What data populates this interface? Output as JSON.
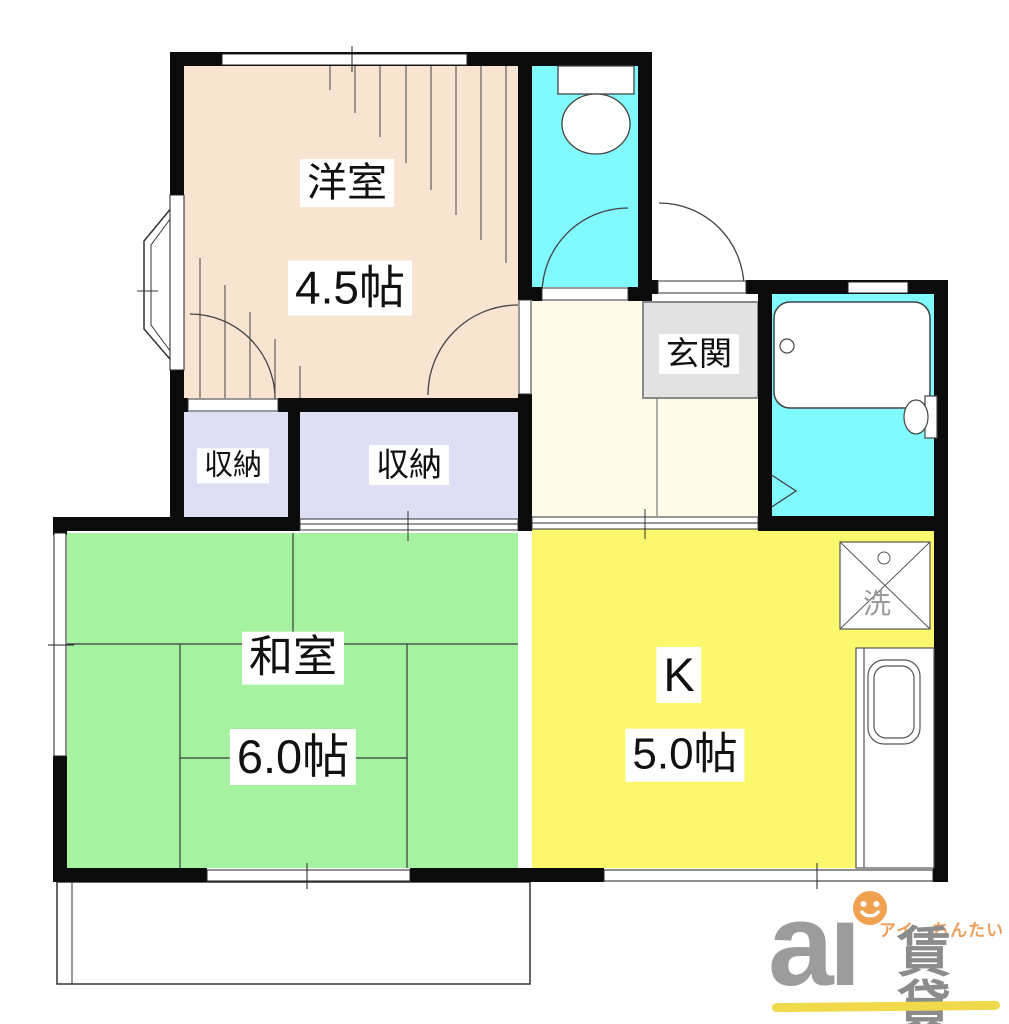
{
  "plan": {
    "rooms": {
      "western": {
        "label": "洋室",
        "size": "4.5帖"
      },
      "japanese": {
        "label": "和室",
        "size": "6.0帖"
      },
      "kitchen": {
        "label": "K",
        "size": "5.0帖"
      },
      "entrance": {
        "label": "玄関"
      },
      "storage_small": {
        "label": "収納"
      },
      "storage_large": {
        "label": "収納"
      },
      "laundry_pan": {
        "label": "洗"
      }
    },
    "colors": {
      "wall": "#0b0b0b",
      "western_room": "#f9e4d2",
      "water_area": "#80f9ff",
      "hallway": "#fefce8",
      "storage": "#dedef5",
      "japanese_room": "#a5f2a0",
      "kitchen": "#fbf86e",
      "entrance_floor": "#e2e2e2",
      "fixture_line": "#444444"
    }
  },
  "logo": {
    "wordmark": "aı",
    "kana": "アイ・ちんたい",
    "kanji": "賃貸",
    "gray": "#9c9c9c",
    "orange": "#ed9e5c",
    "underline": "#f0d94a"
  }
}
